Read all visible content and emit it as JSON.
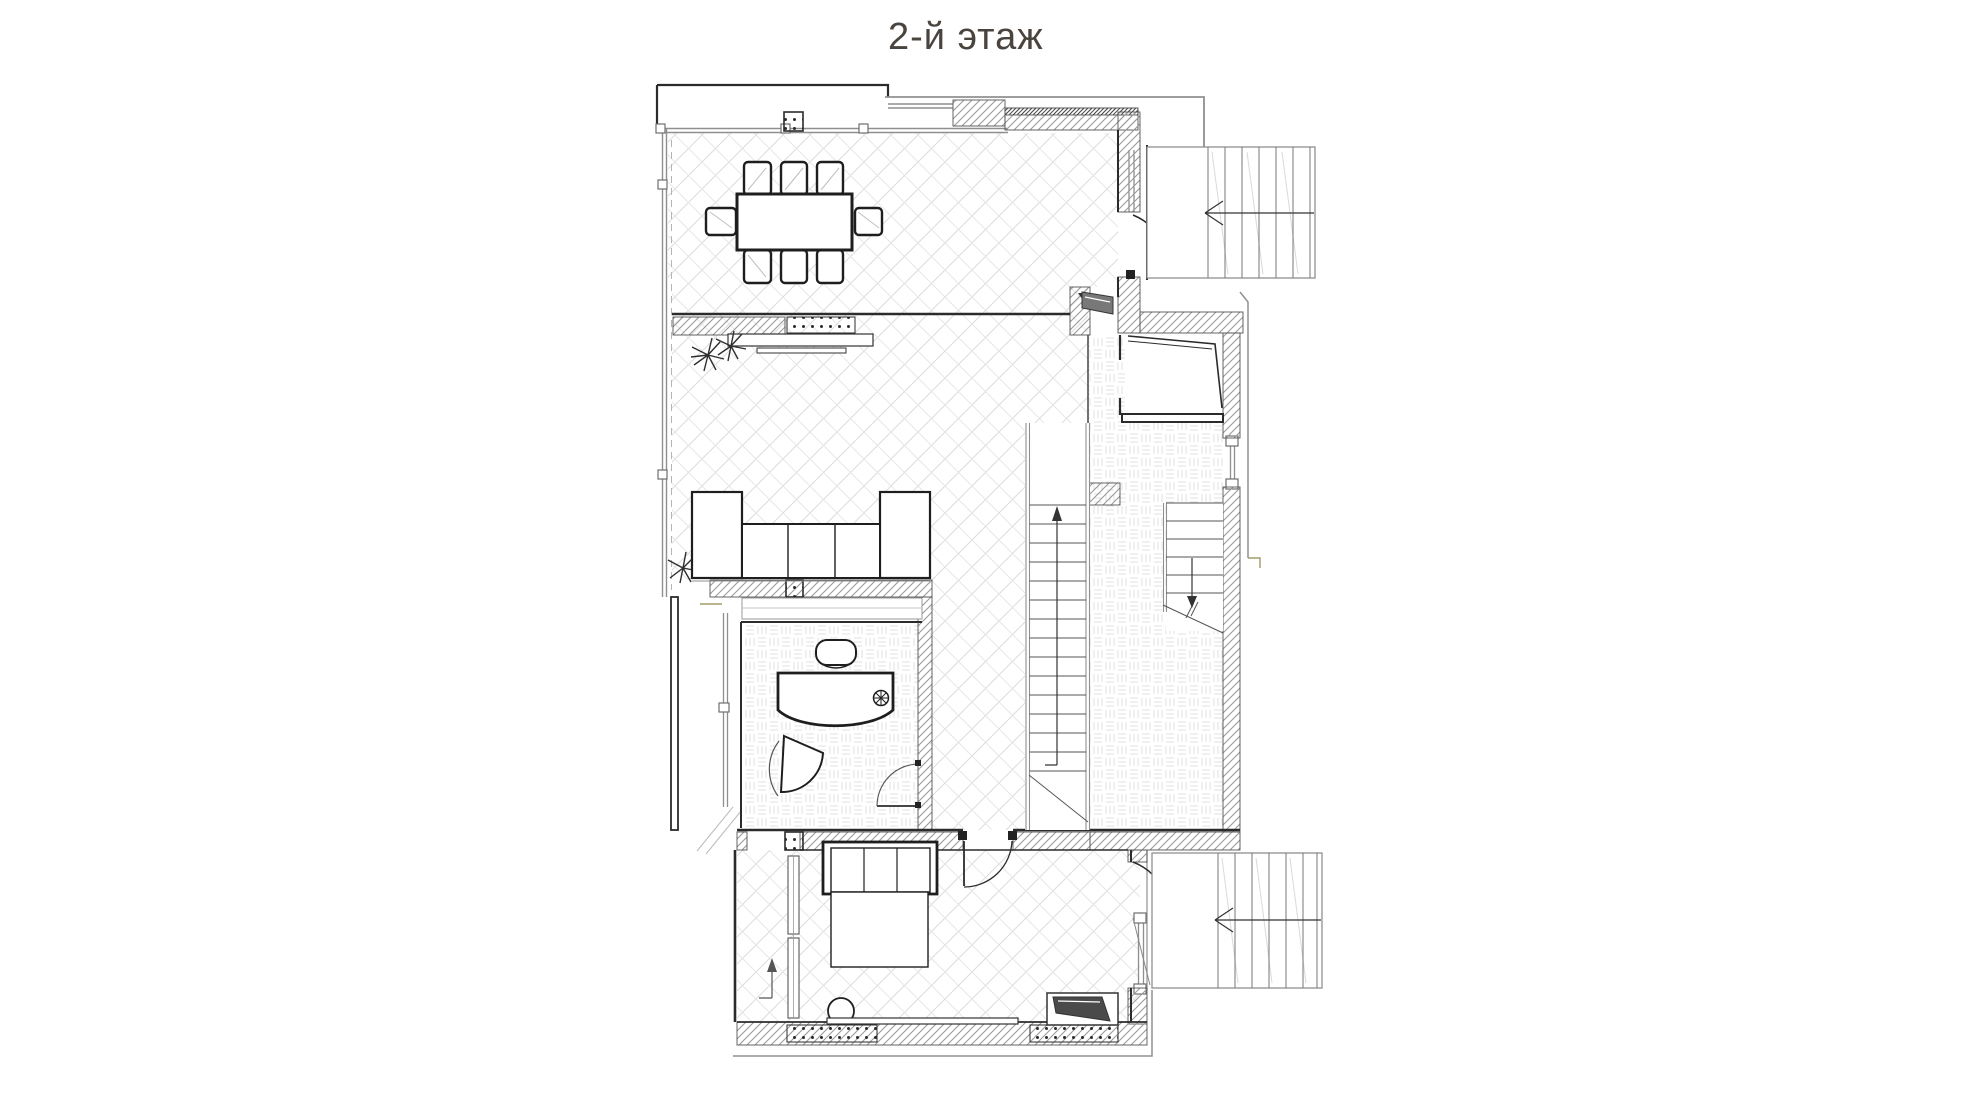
{
  "title": "2-й этаж",
  "plan": {
    "colors": {
      "title_color": "#4a443f",
      "line_dark": "#2b2b2b",
      "line_gray": "#8f8f8f",
      "wall_hatch": "#9a9a9a",
      "floor_pattern": "#dcdcdc",
      "accent_olive": "#a39b6a",
      "door_leaf_fill": "#787878"
    },
    "legend": {
      "stair_direction_top_right": "left",
      "stair_direction_bottom_right": "left",
      "stair_direction_center": "up",
      "stair_direction_inner_upper": "down"
    }
  }
}
